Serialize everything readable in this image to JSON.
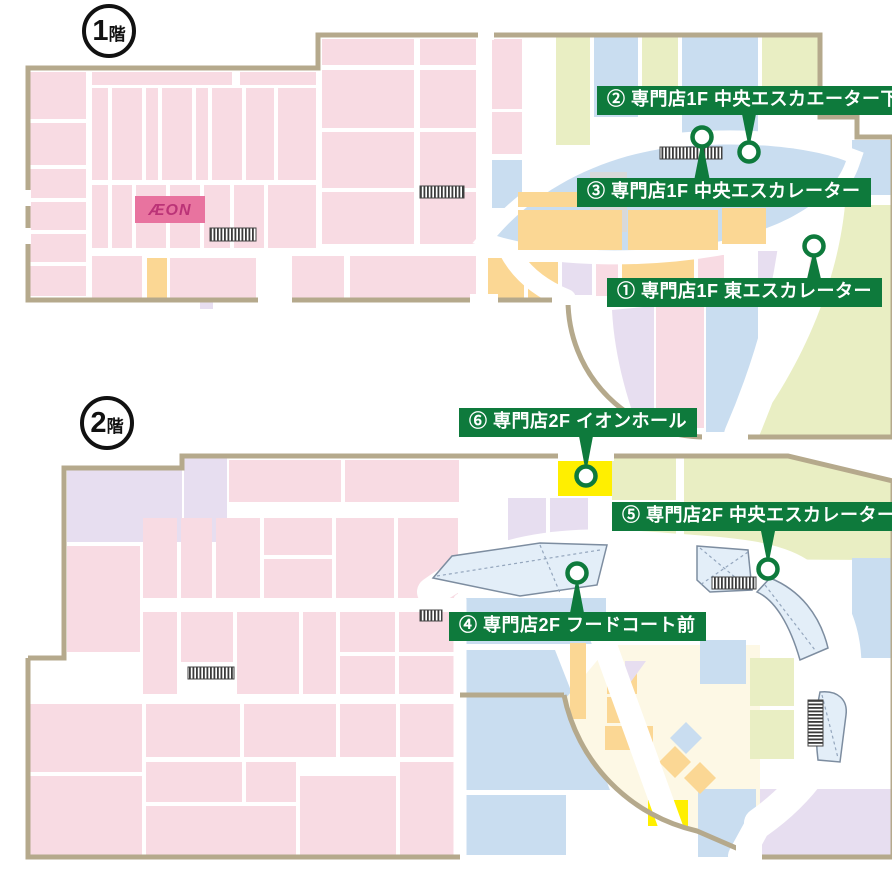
{
  "colors": {
    "label_bg": "#0e7a3c",
    "label_text": "#ffffff",
    "pin_ring": "#0e7a3c",
    "outline": "#b5a98c",
    "store_pink": "#f8dbe3",
    "zone_blue": "#c9ddf0",
    "zone_lime": "#e9eec3",
    "zone_orange": "#fbd794",
    "zone_lavender": "#e7def0",
    "zone_cream": "#fdf8e5",
    "bright_yellow": "#ffef00",
    "island_fill": "#e3eef8",
    "gray_block": "#d9d9d9",
    "aeon_bg": "#e8739f",
    "aeon_text": "#bb3377"
  },
  "floor1": {
    "badge": {
      "number": "1",
      "suffix": "階"
    },
    "aeon_label": "ÆON"
  },
  "floor2": {
    "badge": {
      "number": "2",
      "suffix": "階"
    }
  },
  "markers": [
    {
      "id": "1",
      "label": "① 専門店1F 東エスカレーター"
    },
    {
      "id": "2",
      "label": "② 専門店1F 中央エスカエーター下"
    },
    {
      "id": "3",
      "label": "③ 専門店1F 中央エスカレーター"
    },
    {
      "id": "4",
      "label": "④ 専門店2F フードコート前"
    },
    {
      "id": "5",
      "label": "⑤ 専門店2F 中央エスカレーター"
    },
    {
      "id": "6",
      "label": "⑥ 専門店2F イオンホール"
    }
  ]
}
